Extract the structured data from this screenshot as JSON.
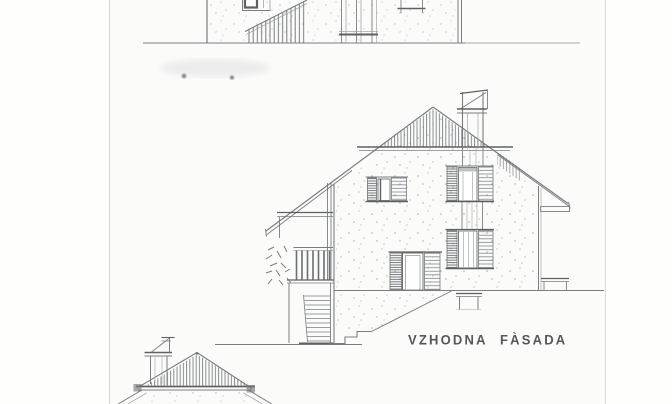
{
  "caption": {
    "label": "VZHODNA FÀSADA"
  },
  "colors": {
    "paper": "#fbfbfa",
    "ink": "#73777a",
    "ink_dark": "#55585b",
    "caption_text": "#54585a"
  }
}
